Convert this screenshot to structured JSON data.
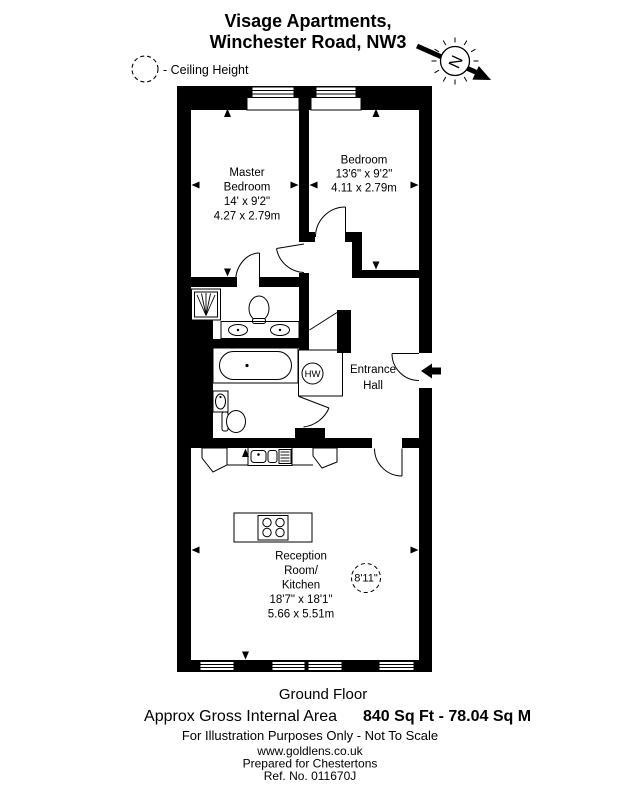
{
  "title": {
    "line1": "Visage Apartments,",
    "line2": "Winchester Road, NW3"
  },
  "legend": {
    "ceiling_height": "- Ceiling Height"
  },
  "compass": {
    "north": "N"
  },
  "plan": {
    "master_bedroom": {
      "line1": "Master",
      "line2": "Bedroom",
      "imperial": "14' x 9'2\"",
      "metric": "4.27 x 2.79m"
    },
    "bedroom": {
      "line1": "Bedroom",
      "imperial": "13'6\" x 9'2\"",
      "metric": "4.11 x 2.79m"
    },
    "entrance_hall": {
      "line1": "Entrance",
      "line2": "Hall"
    },
    "reception": {
      "line1": "Reception",
      "line2": "Room/",
      "line3": "Kitchen",
      "imperial": "18'7\" x 18'1\"",
      "metric": "5.66 x 5.51m"
    },
    "ceiling_height_value": "8'11\"",
    "hw": "HW"
  },
  "footer": {
    "floor_label": "Ground Floor",
    "area_label": "Approx Gross Internal Area",
    "area_value": "840 Sq Ft  -  78.04 Sq M",
    "disclaimer": "For Illustration Purposes Only - Not To Scale",
    "website": "www.goldlens.co.uk",
    "prepared_for": "Prepared for Chestertons",
    "reference": "Ref. No. 011670J"
  },
  "colors": {
    "ink": "#000000",
    "paper": "#ffffff"
  }
}
